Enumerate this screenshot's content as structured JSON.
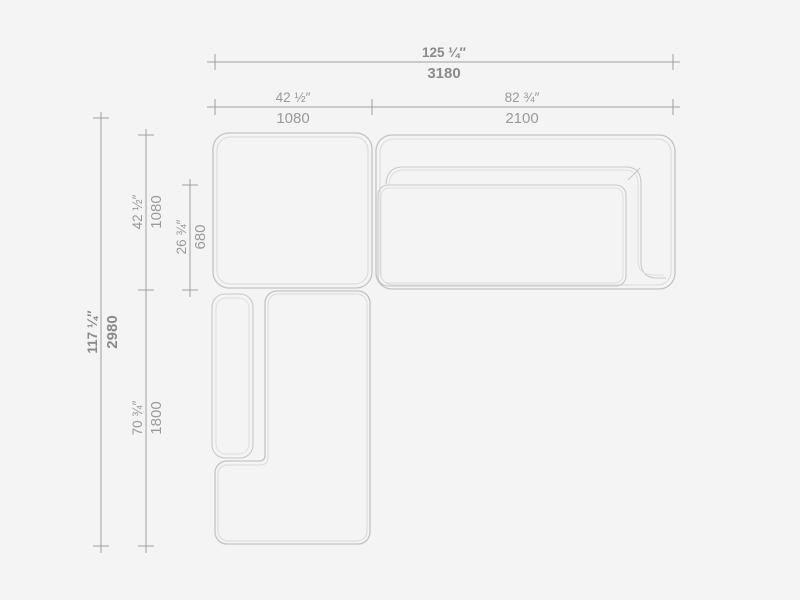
{
  "page": {
    "background": "#f4f4f4",
    "description_colors": {
      "module_outline": "#c3c3c3",
      "module_outline_inner": "#d9d9d9",
      "dimension_line": "#9f9f9f",
      "label_primary": "#8a8a8a",
      "label_secondary": "#9a9a9a"
    }
  },
  "dimensions": {
    "overall_width": {
      "inches": "125 ¼″",
      "mm": "3180"
    },
    "section_width_left": {
      "inches": "42 ½″",
      "mm": "1080"
    },
    "section_width_right": {
      "inches": "82 ¾″",
      "mm": "2100"
    },
    "overall_depth": {
      "inches": "117 ¼″",
      "mm": "2980"
    },
    "section_depth_top": {
      "inches": "42 ½″",
      "mm": "1080"
    },
    "seat_depth_inner": {
      "inches": "26 ¾″",
      "mm": "680"
    },
    "section_depth_bottom": {
      "inches": "70 ¾″",
      "mm": "1800"
    }
  }
}
